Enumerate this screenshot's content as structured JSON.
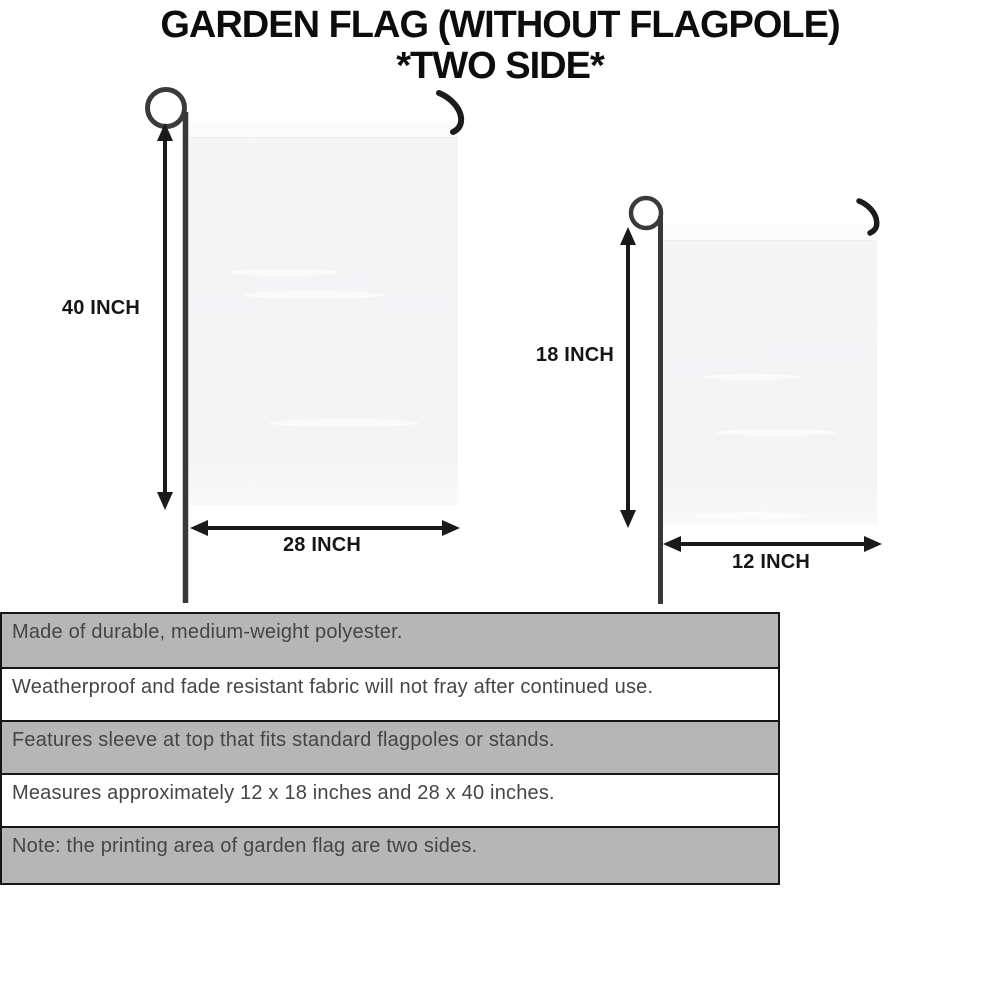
{
  "title": {
    "line1": "GARDEN FLAG (WITHOUT FLAGPOLE)",
    "line2": "*TWO SIDE*"
  },
  "large_flag": {
    "height_label": "40 INCH",
    "width_label": "28 INCH"
  },
  "small_flag": {
    "height_label": "18 INCH",
    "width_label": "12 INCH"
  },
  "features": [
    "Made of durable, medium-weight polyester.",
    "Weatherproof and fade resistant fabric will not fray after continued use.",
    "Features sleeve at top that fits standard flagpoles or stands.",
    "Measures approximately 12 x 18 inches and 28 x 40 inches.",
    "Note: the printing area of garden flag are two sides."
  ],
  "colors": {
    "stripe_gray": "#b6b6b6",
    "stripe_border": "#161616",
    "stripe_text": "#454545",
    "flag_fill": "#f5f5f6",
    "pole": "#383838",
    "hook": "#1c1c1c",
    "arrow": "#1a1a1a",
    "title_text": "#0d0d0d"
  }
}
